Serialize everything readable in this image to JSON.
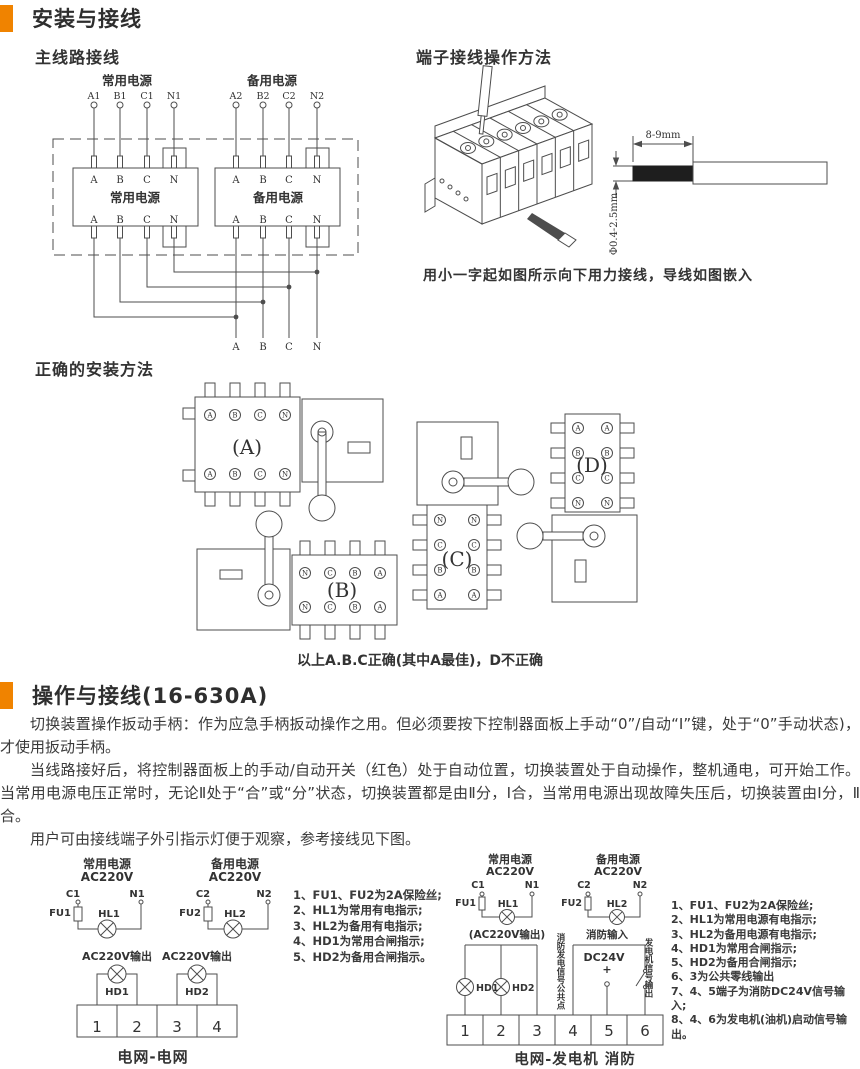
{
  "accent_color": "#F08300",
  "line_color": "#4d4d4d",
  "sections": {
    "install_title": "安装与接线",
    "operate_title": "操作与接线(16-630A)"
  },
  "power": {
    "normal": "常用电源",
    "backup": "备用电源",
    "voltage": "AC220V"
  },
  "main_wiring": {
    "title": "主线路接线",
    "top_terminals": [
      "A1",
      "B1",
      "C1",
      "N1",
      "A2",
      "B2",
      "C2",
      "N2"
    ],
    "phase_labels": [
      "A",
      "B",
      "C",
      "N"
    ]
  },
  "terminal_method": {
    "title": "端子接线操作方法",
    "strip_length": "8-9mm",
    "wire_diameter": "Φ0.4-2.5mm",
    "caption": "用小一字起如图所示向下用力接线，导线如图嵌入"
  },
  "installation": {
    "title": "正确的安装方法",
    "variant_labels": [
      "(A)",
      "(B)",
      "(C)",
      "(D)"
    ],
    "terminals_fwd": [
      "A",
      "B",
      "C",
      "N"
    ],
    "terminals_rev": [
      "N",
      "C",
      "B",
      "A"
    ],
    "caption": "以上A.B.C正确(其中A最佳)，D不正确"
  },
  "operation_paragraphs": [
    "切换装置操作扳动手柄：作为应急手柄扳动操作之用。但必须要按下控制器面板上手动“0”/自动“I”键，处于“0”手动状态)，才使用扳动手柄。",
    "当线路接好后，将控制器面板上的手动/自动开关（红色）处于自动位置，切换装置处于自动操作，整机通电，可开始工作。当常用电源电压正常时，无论Ⅱ处于“合”或“分”状态，切换装置都是由Ⅱ分，Ⅰ合，当常用电源出现故障失压后，切换装置由Ⅰ分，Ⅱ合。",
    "用户可由接线端子外引指示灯便于观察，参考接线见下图。"
  ],
  "terms": {
    "c1": "C1",
    "n1": "N1",
    "c2": "C2",
    "n2": "N2",
    "fu1": "FU1",
    "fu2": "FU2",
    "hl1": "HL1",
    "hl2": "HL2",
    "hd1": "HD1",
    "hd2": "HD2"
  },
  "grid_grid": {
    "output_label": "AC220V输出",
    "terminal_numbers": [
      "1",
      "2",
      "3",
      "4"
    ],
    "caption": "电网-电网"
  },
  "grid_gen": {
    "output_label": "(AC220V输出)",
    "fire_input": "消防输入",
    "fire_common": "消防发电信号公共点",
    "gen_signal": "发电机信号输出",
    "dc_label": "DC24V",
    "plus": "+",
    "terminal_numbers": [
      "1",
      "2",
      "3",
      "4",
      "5",
      "6"
    ],
    "caption": "电网-发电机 消防"
  },
  "notes_left": [
    "1、FU1、FU2为2A保险丝;",
    "2、HL1为常用有电指示;",
    "3、HL2为备用有电指示;",
    "4、HD1为常用合闸指示;",
    "5、HD2为备用合闸指示。"
  ],
  "notes_right": [
    "1、FU1、FU2为2A保险丝;",
    "2、HL1为常用电源有电指示;",
    "3、HL2为备用电源有电指示;",
    "4、HD1为常用合闸指示;",
    "5、HD2为备用合闸指示;",
    "6、3为公共零线输出",
    "7、4、5端子为消防DC24V信号输入;",
    "8、4、6为发电机(油机)启动信号输出。"
  ]
}
